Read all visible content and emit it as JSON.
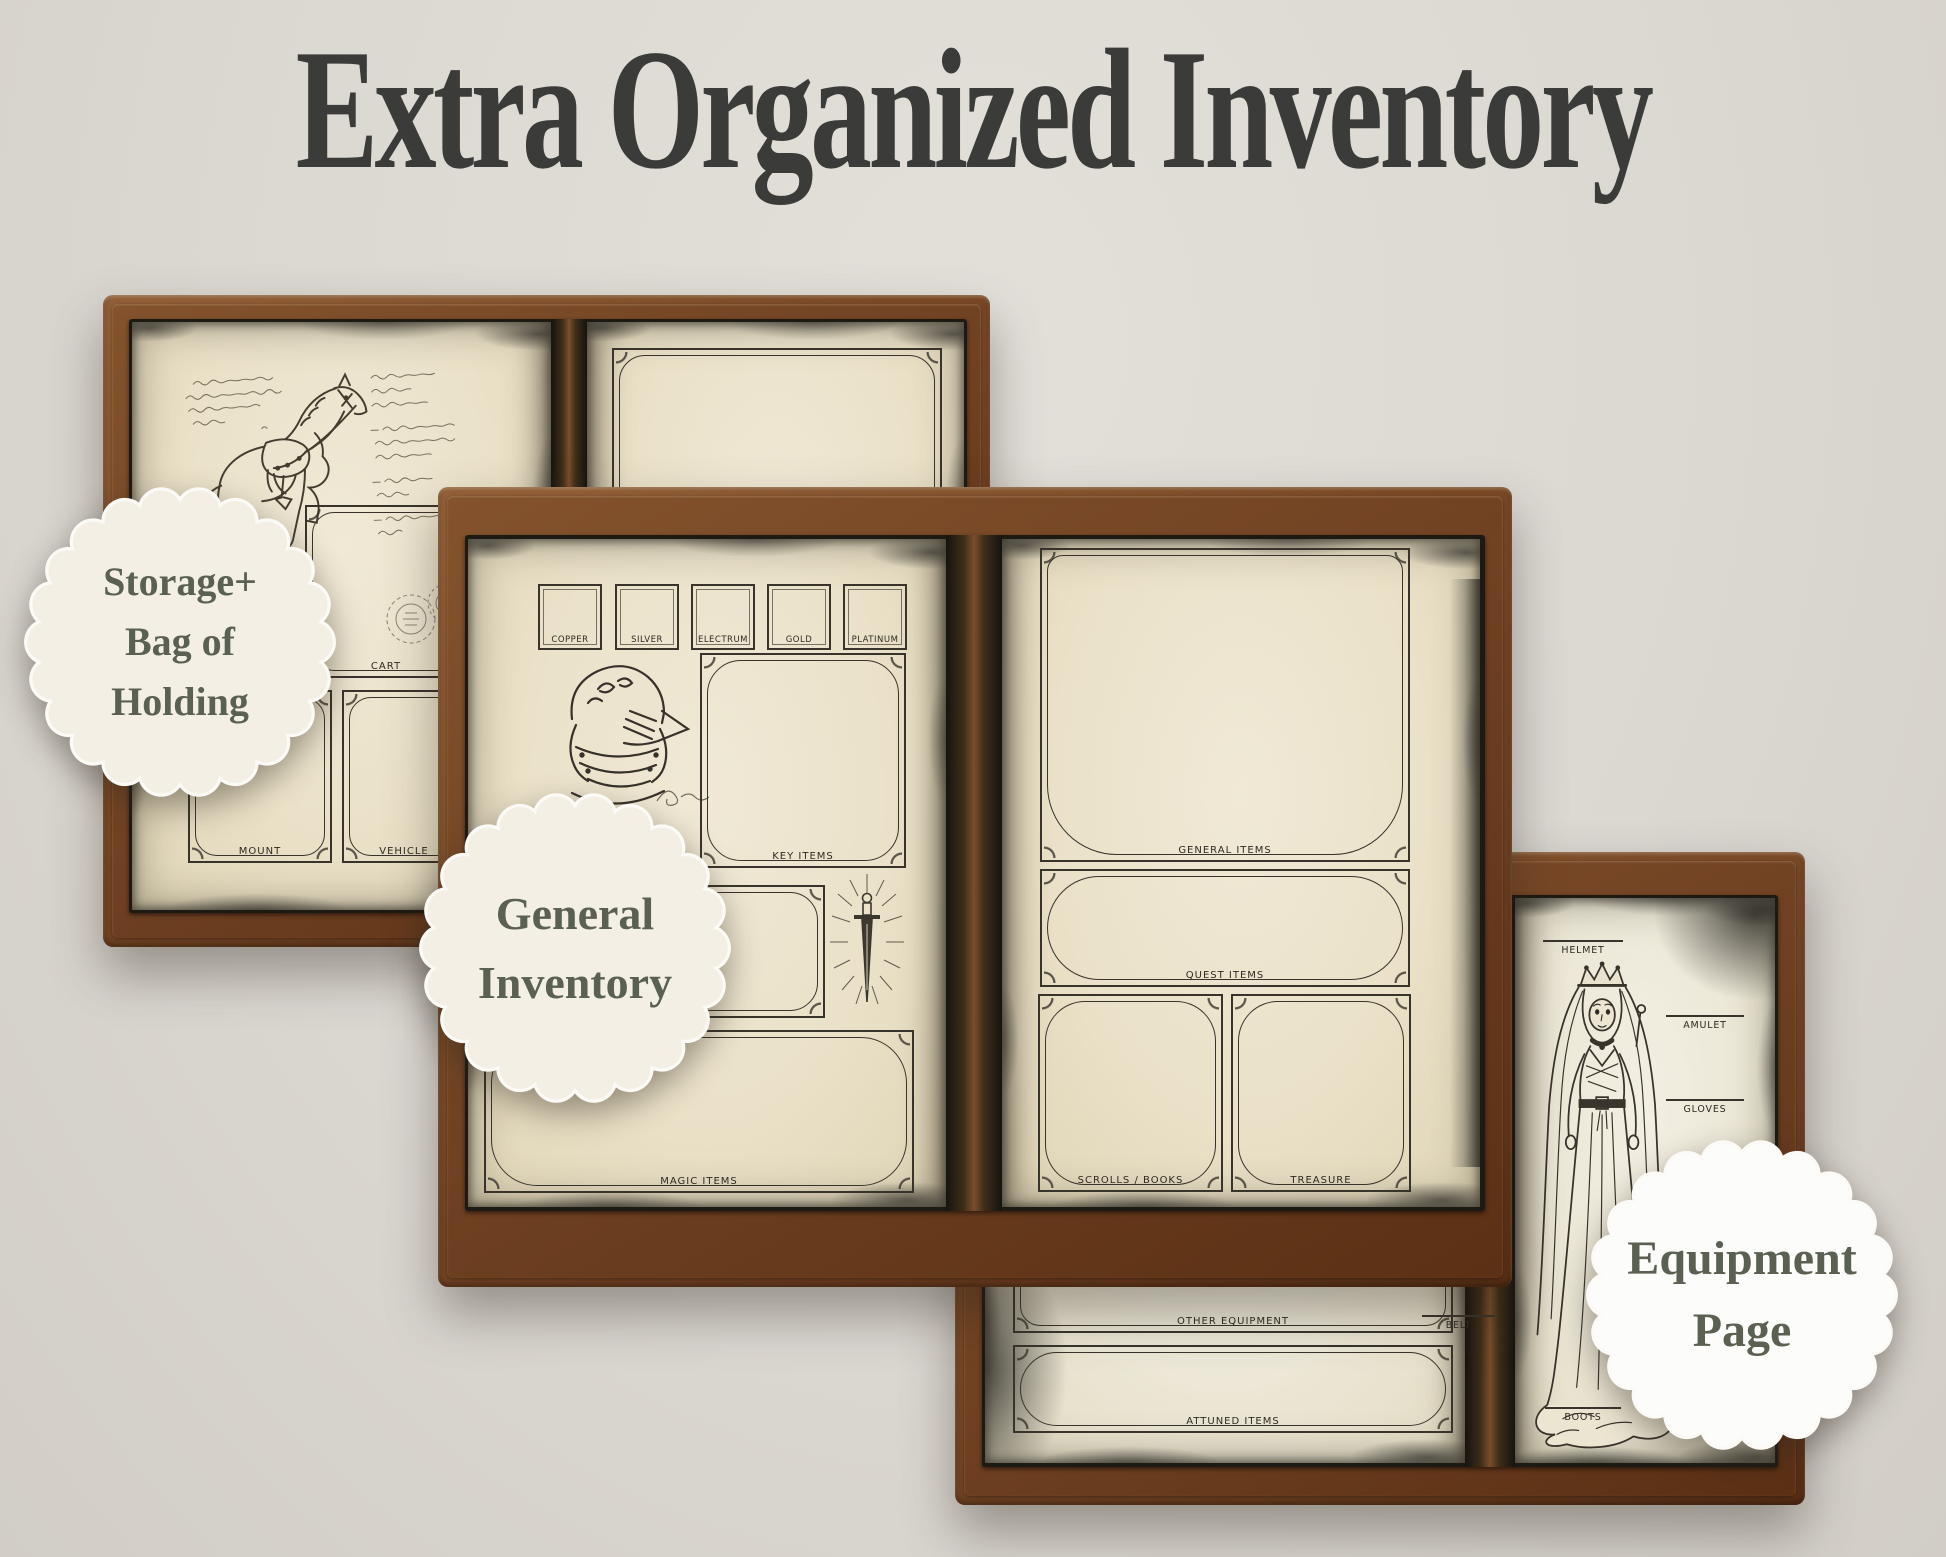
{
  "page": {
    "title": "Extra Organized Inventory",
    "title_color": "#3b3b39",
    "background_color": "#dcd8d2"
  },
  "palette": {
    "leather_brown": "#7a4a27",
    "leather_dark": "#5b3014",
    "aged_paper": "#eae1c8",
    "ink": "#38342b",
    "burnt_edge": "#34322c",
    "badge_cream": "#f3efe4",
    "badge_white": "#fcfcfa",
    "badge_text_green": "#5a6052"
  },
  "badges": {
    "storage": {
      "lines": [
        "Storage+",
        "Bag of",
        "Holding"
      ],
      "fill": "#f3efe4",
      "text_color": "#5a6052"
    },
    "general": {
      "lines": [
        "General",
        "Inventory"
      ],
      "fill": "#f3efe4",
      "text_color": "#5a6052"
    },
    "equipment": {
      "lines": [
        "Equipment",
        "Page"
      ],
      "fill": "#fcfcfa",
      "text_color": "#5a6052"
    }
  },
  "storage_book": {
    "left_page": {
      "frames": {
        "cart": "CART",
        "mount": "MOUNT",
        "vehicle": "VEHICLE"
      },
      "illustrations": [
        "war-horse-sketch",
        "handwritten-notes",
        "postmark-stamps"
      ]
    },
    "right_page": {
      "frame_label": ""
    }
  },
  "general_book": {
    "left_page": {
      "currency": [
        "COPPER",
        "SILVER",
        "ELECTRUM",
        "GOLD",
        "PLATINUM"
      ],
      "key_items_label": "KEY ITEMS",
      "magic_items_label": "MAGIC ITEMS",
      "illustrations": [
        "knight-helmet-sketch",
        "radiant-sword-sketch",
        "signature-scribble"
      ]
    },
    "right_page": {
      "general_items_label": "GENERAL ITEMS",
      "quest_items_label": "QUEST ITEMS",
      "scrolls_books_label": "SCROLLS / BOOKS",
      "treasure_label": "TREASURE"
    }
  },
  "equipment_book": {
    "left_page": {
      "other_equipment_label": "OTHER EQUIPMENT",
      "attuned_items_label": "ATTUNED ITEMS",
      "belt_label": "BELT"
    },
    "right_page": {
      "helmet_label": "HELMET",
      "amulet_label": "AMULET",
      "gloves_label": "GLOVES",
      "boots_label": "BOOTS",
      "illustrations": [
        "crowned-lady-sketch"
      ]
    }
  }
}
